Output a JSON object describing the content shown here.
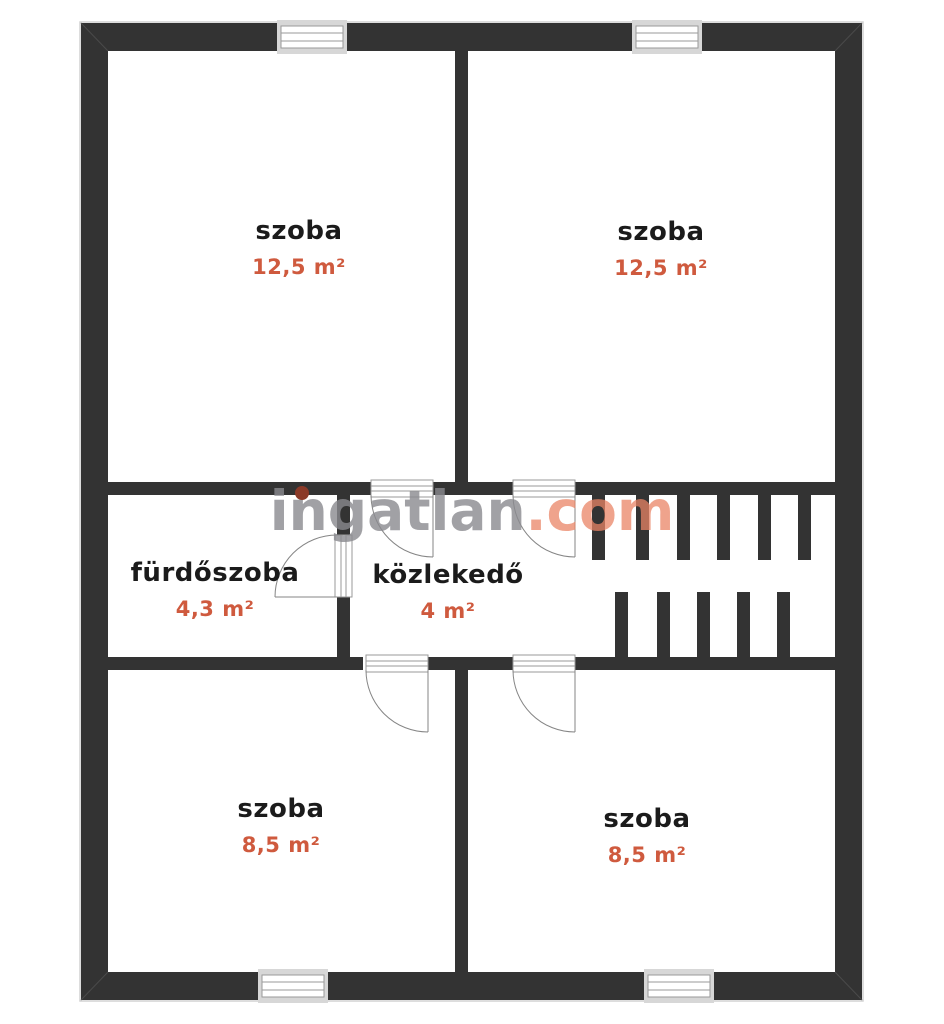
{
  "plan": {
    "rooms": [
      {
        "name": "szoba",
        "area": "12,5 m²"
      },
      {
        "name": "szoba",
        "area": "12,5 m²"
      },
      {
        "name": "fürdőszoba",
        "area": "4,3 m²"
      },
      {
        "name": "közlekedő",
        "area": "4 m²"
      },
      {
        "name": "szoba",
        "area": "8,5 m²"
      },
      {
        "name": "szoba",
        "area": "8,5 m²"
      }
    ]
  },
  "watermark": {
    "name": "ingatlan",
    "tld": ".com"
  },
  "colors": {
    "wall": "#333333",
    "accent": "#cf5a3e",
    "roomtext": "#1b1b1b",
    "frame": "#9a9a9a",
    "wmgray": "rgba(138,138,143,0.8)",
    "wmsalmon": "rgba(233,132,102,0.75)",
    "wmdot": "#8b3a28"
  }
}
